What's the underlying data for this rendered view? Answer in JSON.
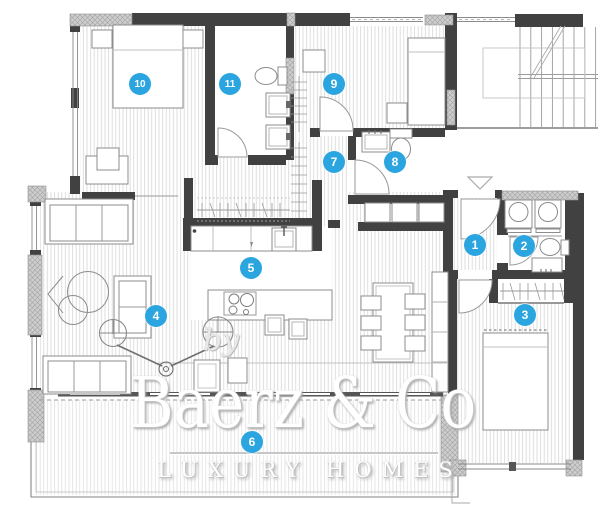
{
  "watermark": {
    "by": "by",
    "brand": "Baerz & Co",
    "tagline": "LUXURY HOMES"
  },
  "markers": [
    {
      "label": "1",
      "x": 475,
      "y": 245
    },
    {
      "label": "2",
      "x": 524,
      "y": 246
    },
    {
      "label": "3",
      "x": 525,
      "y": 315
    },
    {
      "label": "4",
      "x": 156,
      "y": 316
    },
    {
      "label": "5",
      "x": 251,
      "y": 268
    },
    {
      "label": "6",
      "x": 252,
      "y": 442
    },
    {
      "label": "7",
      "x": 334,
      "y": 162
    },
    {
      "label": "8",
      "x": 395,
      "y": 162
    },
    {
      "label": "9",
      "x": 334,
      "y": 84
    },
    {
      "label": "10",
      "x": 140,
      "y": 84
    },
    {
      "label": "11",
      "x": 230,
      "y": 84
    }
  ],
  "colors": {
    "marker_blue": "#2ba5df",
    "wall_dark": "#414141",
    "wall_hatched": "#c9c9c9",
    "floor_hatch_line": "#d6d6d6",
    "watermark_white": "#ffffff"
  }
}
